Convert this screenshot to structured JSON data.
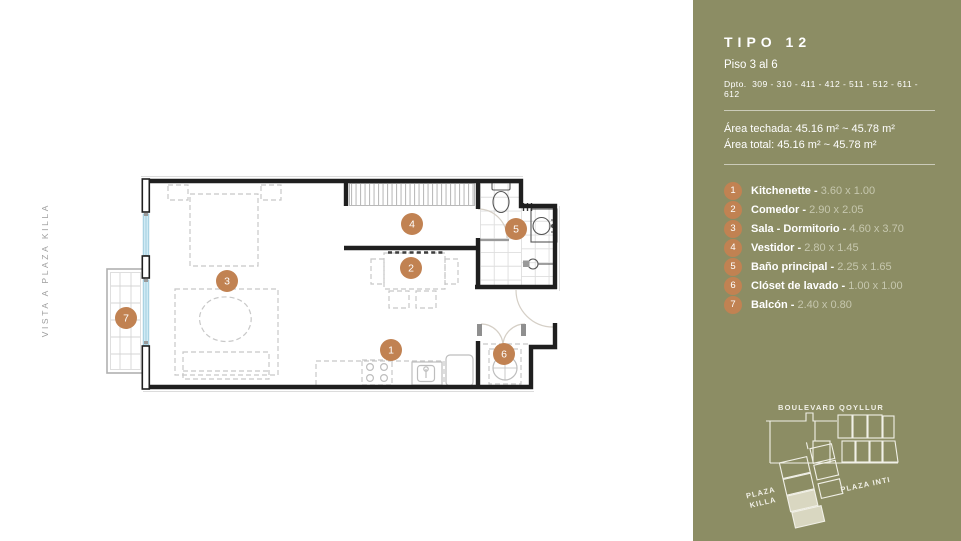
{
  "colors": {
    "panel_olive": "#8c8d64",
    "accent_orange": "#c18252",
    "dims_muted": "#c6c7ae",
    "map_highlight": "#d9d7c1",
    "window_blue": "#cfeaf4",
    "wall": "#1f1f1f"
  },
  "plan": {
    "side_label": "VISTA A PLAZA KILLA",
    "markers": [
      {
        "n": "1",
        "x": 391,
        "y": 350
      },
      {
        "n": "2",
        "x": 411,
        "y": 268
      },
      {
        "n": "3",
        "x": 227,
        "y": 281
      },
      {
        "n": "4",
        "x": 412,
        "y": 224
      },
      {
        "n": "5",
        "x": 516,
        "y": 229
      },
      {
        "n": "6",
        "x": 504,
        "y": 354
      },
      {
        "n": "7",
        "x": 126,
        "y": 318
      }
    ]
  },
  "panel": {
    "title": "TIPO 12",
    "floor": "Piso 3 al 6",
    "dpto_label": "Dpto.",
    "dpto_numbers": "309 - 310 - 411 - 412 - 511 - 512 - 611 - 612",
    "area_techada": "Área techada: 45.16 m² ~ 45.78 m²",
    "area_total": "Área total: 45.16 m² ~ 45.78 m²",
    "legend_separator": " - ",
    "legend": [
      {
        "num": "1",
        "name": "Kitchenette",
        "dims": "3.60 x 1.00"
      },
      {
        "num": "2",
        "name": "Comedor",
        "dims": "2.90 x 2.05"
      },
      {
        "num": "3",
        "name": "Sala - Dormitorio",
        "dims": "4.60 x 3.70"
      },
      {
        "num": "4",
        "name": "Vestidor",
        "dims": "2.80 x 1.45"
      },
      {
        "num": "5",
        "name": "Baño principal",
        "dims": "2.25 x 1.65"
      },
      {
        "num": "6",
        "name": "Clóset de lavado",
        "dims": "1.00 x 1.00"
      },
      {
        "num": "7",
        "name": "Balcón",
        "dims": "2.40 x 0.80"
      }
    ],
    "map": {
      "street": "BOULEVARD QOYLLUR",
      "plaza_left_1": "PLAZA",
      "plaza_left_2": "KILLA",
      "plaza_right": "PLAZA INTI"
    }
  }
}
